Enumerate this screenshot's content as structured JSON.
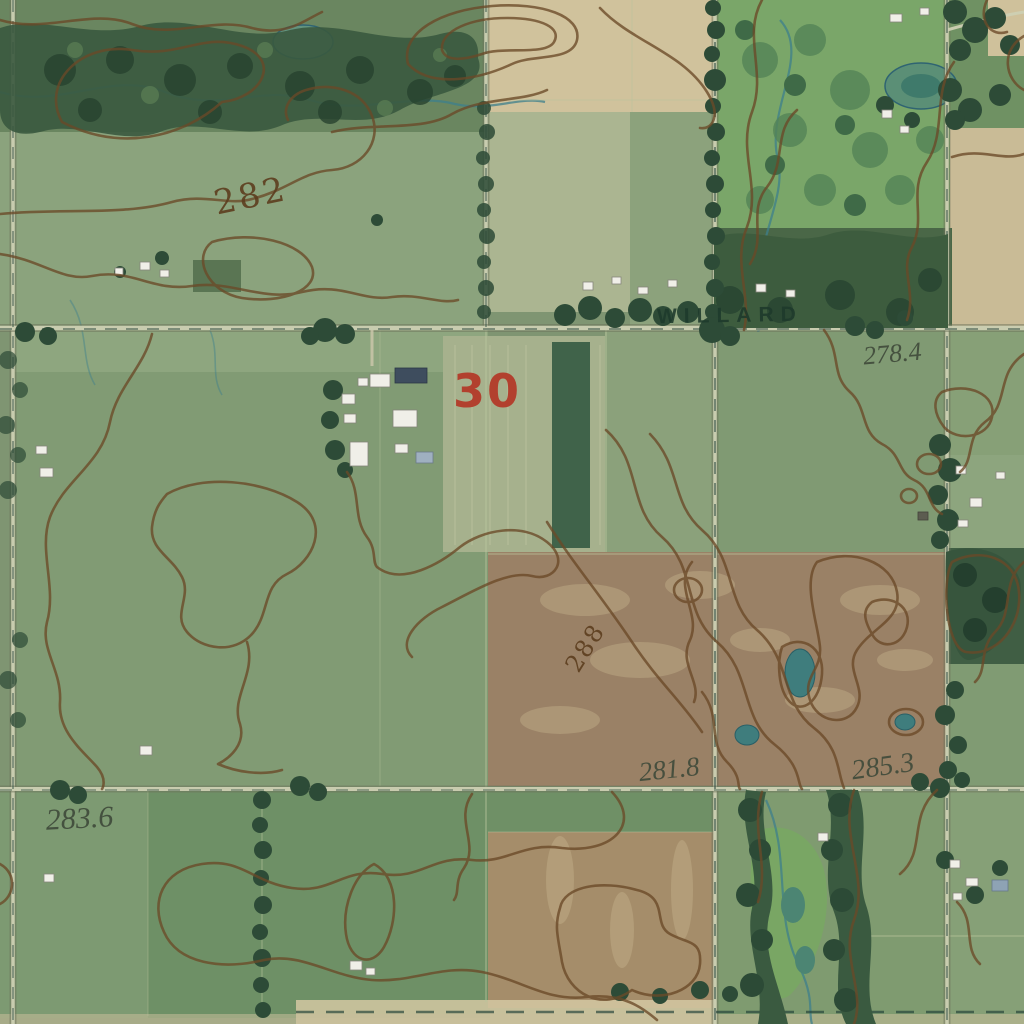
{
  "map": {
    "road_label": "WILLARD",
    "section_number": "30",
    "contour_labels": {
      "left_field": "282",
      "center_ridge": "288"
    },
    "spot_elevations": {
      "northeast": "278.4",
      "south_center": "281.8",
      "southeast": "285.3",
      "southwest": "283.6"
    },
    "colors": {
      "contour": "#6b4a28",
      "contour_label": "#5c3d1e",
      "section_number": "#b2402e",
      "road_label": "#1e3a2c",
      "spot_elevation": "#3f4a3a",
      "water": "#3e7f8c"
    }
  }
}
